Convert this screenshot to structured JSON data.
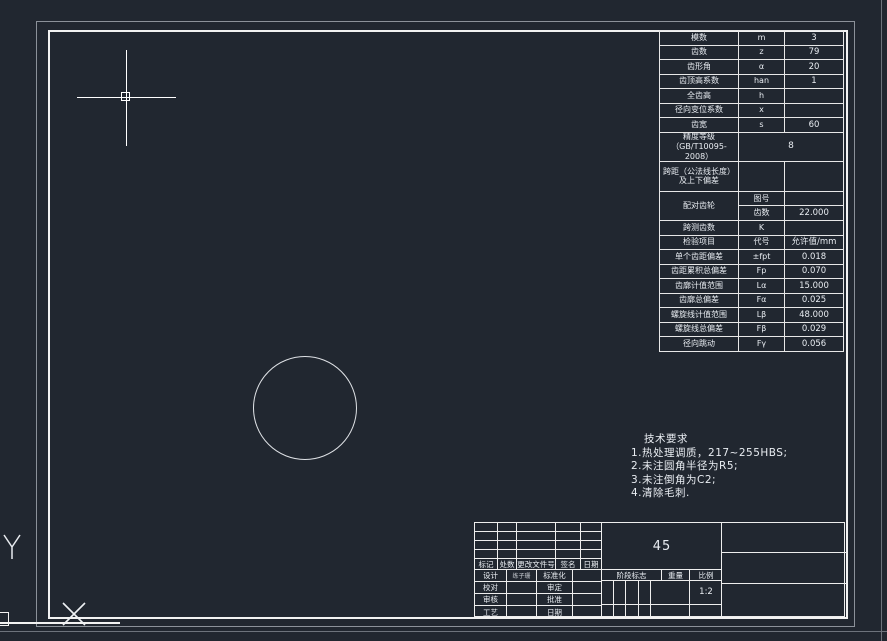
{
  "colors": {
    "background": "#212730",
    "line_white": "#f2f2f2",
    "frame_gray": "#8b9199",
    "text": "#e9edf2"
  },
  "gear_table": {
    "rows": [
      {
        "name": "模数",
        "symbol": "m",
        "value": "3"
      },
      {
        "name": "齿数",
        "symbol": "z",
        "value": "79"
      },
      {
        "name": "齿形角",
        "symbol": "α",
        "value": "20"
      },
      {
        "name": "齿顶高系数",
        "symbol": "han",
        "value": "1"
      },
      {
        "name": "全齿高",
        "symbol": "h",
        "value": ""
      },
      {
        "name": "径向变位系数",
        "symbol": "x",
        "value": ""
      },
      {
        "name": "齿宽",
        "symbol": "s",
        "value": "60"
      },
      {
        "name": "精度等级\n（GB/T10095-2008）",
        "type": "span",
        "value": "8",
        "tall": true
      },
      {
        "name": "跨距（公法线长度）\n及上下偏差",
        "symbol": "",
        "value": "",
        "tall": true
      },
      {
        "name": "配对齿轮",
        "type": "pair",
        "tall": true,
        "sub": [
          {
            "symbol": "图号",
            "value": ""
          },
          {
            "symbol": "齿数",
            "value": "22.000"
          }
        ]
      },
      {
        "name": "跨测齿数",
        "symbol": "K",
        "value": ""
      },
      {
        "name": "检验项目",
        "symbol": "代号",
        "value": "允许值/mm"
      },
      {
        "name": "单个齿距偏差",
        "symbol": "±fpt",
        "value": "0.018"
      },
      {
        "name": "齿距累积总偏差",
        "symbol": "Fp",
        "value": "0.070"
      },
      {
        "name": "齿廓计值范围",
        "symbol": "Lα",
        "value": "15.000"
      },
      {
        "name": "齿廓总偏差",
        "symbol": "Fα",
        "value": "0.025"
      },
      {
        "name": "螺旋线计值范围",
        "symbol": "Lβ",
        "value": "48.000"
      },
      {
        "name": "螺旋线总偏差",
        "symbol": "Fβ",
        "value": "0.029"
      },
      {
        "name": "径向跳动",
        "symbol": "Fγ",
        "value": "0.056"
      }
    ]
  },
  "tech": {
    "title": "技术要求",
    "lines": [
      "1.热处理调质，217~255HBS;",
      "2.未注圆角半径为R5;",
      "3.未注倒角为C2;",
      "4.清除毛刺."
    ]
  },
  "title_block": {
    "material": "45",
    "revision_headers": [
      "标记",
      "处数",
      "更改文件号",
      "签名",
      "日期"
    ],
    "sign_rows": [
      {
        "left": "设计",
        "sig": "练子珊",
        "right": "标准化"
      },
      {
        "left": "校对",
        "sig": "",
        "right": "审定"
      },
      {
        "left": "审核",
        "sig": "",
        "right": "批准"
      },
      {
        "left": "工艺",
        "sig": "",
        "right": "日期"
      }
    ],
    "stage_label": "阶段标志",
    "weight_label": "重量",
    "scale_label": "比例",
    "scale_value": "1:2"
  },
  "ucs": {
    "y_label": "Y"
  }
}
